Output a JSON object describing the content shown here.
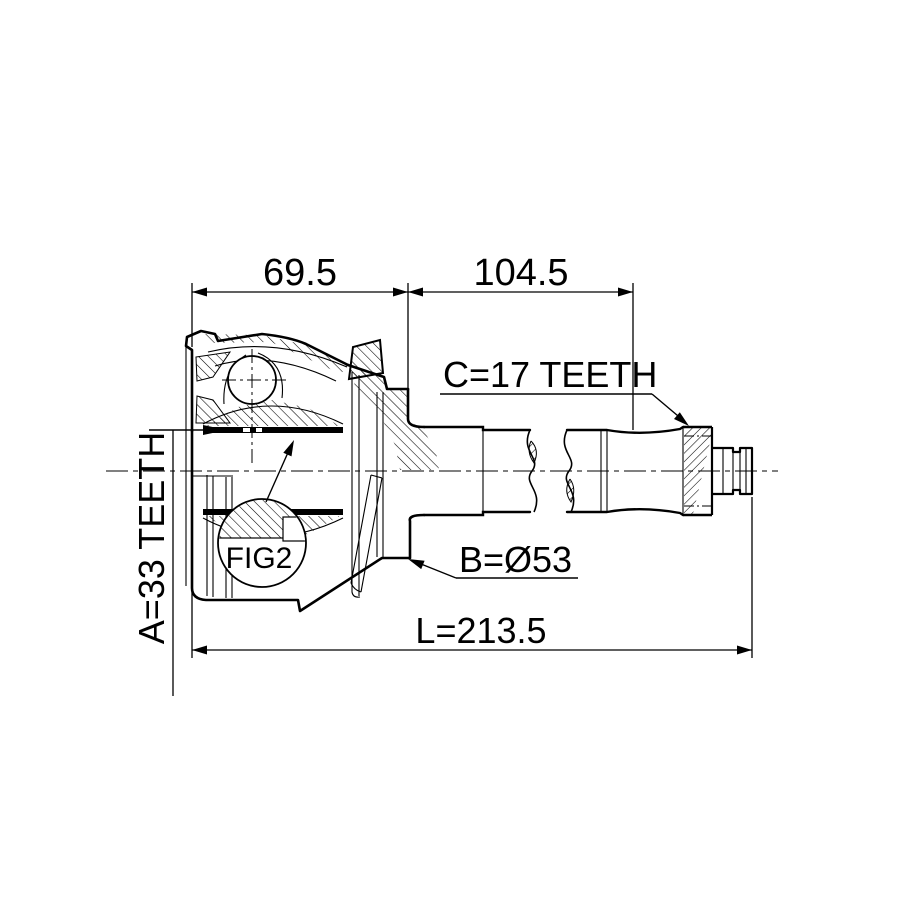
{
  "drawing": {
    "type": "technical-section-drawing",
    "subject": "CV joint outer with axle shaft",
    "dim_top_left": "69.5",
    "dim_top_right": "104.5",
    "dim_overall": "L=213.5",
    "callout_inner_spline": "A=33 TEETH",
    "callout_outer_spline": "C=17 TEETH",
    "callout_diameter": "B=Ø53",
    "detail_label": "FIG2",
    "colors": {
      "line": "#000000",
      "background": "#ffffff"
    }
  }
}
